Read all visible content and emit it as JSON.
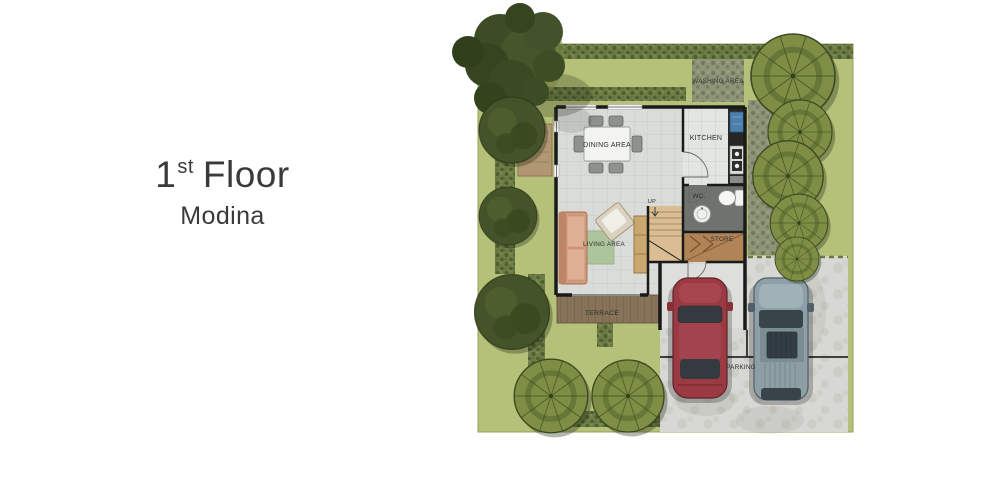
{
  "heading": {
    "floor_number": "1",
    "floor_ordinal": "st",
    "floor_word": "Floor",
    "plan_name": "Modina"
  },
  "floor_plan": {
    "labels": {
      "washing_area": "WASHING AREA",
      "kitchen": "KITCHEN",
      "dining_area": "DINING AREA",
      "wc": "WC.",
      "store": "STORE",
      "up": "UP",
      "living_area": "LIVING AREA",
      "terrace": "TERRACE",
      "parking": "PARKING"
    },
    "colors": {
      "lawn": "#b5c079",
      "hedge": "#6e7d46",
      "tree_olive": "#7f8e45",
      "tree_dark": "#44532a",
      "floor_tile": "#dadcd9",
      "kitchen_tile": "#e3e5e2",
      "wall": "#1a1a1a",
      "terrace_wood": "#87735a",
      "store_floor": "#b08457",
      "stair_wood": "#dabd92",
      "wc_floor": "#6e736e",
      "concrete": "#d7d7d3",
      "car_red": "#9c3a43",
      "car_gray": "#8da0a7",
      "sofa": "#d29a7e",
      "rug": "#abc49a",
      "heading_text": "#3a3a3a"
    }
  }
}
